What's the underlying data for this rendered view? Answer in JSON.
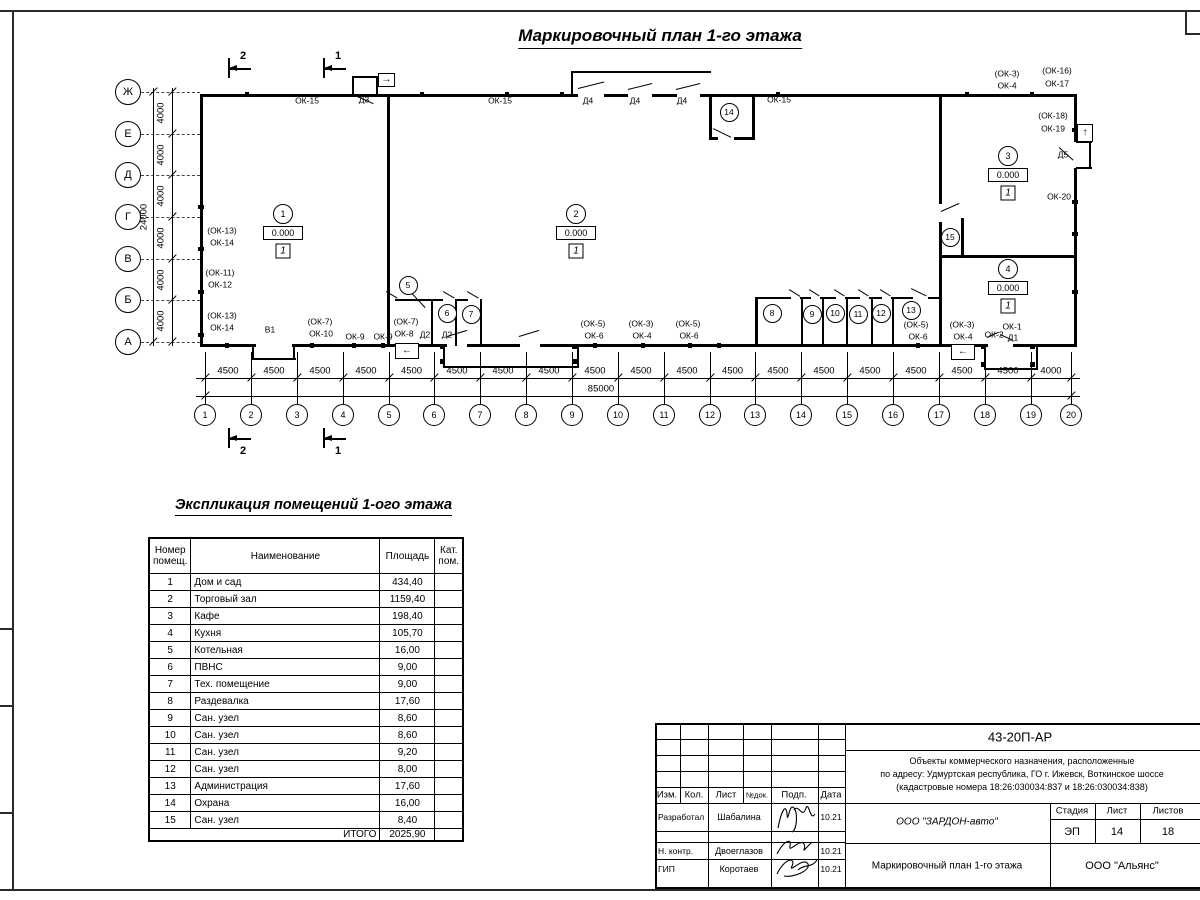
{
  "page": {
    "title": "Маркировочный план 1-го этажа"
  },
  "plan": {
    "axes": [
      {
        "label": "Ж",
        "y": 92
      },
      {
        "label": "Е",
        "y": 134
      },
      {
        "label": "Д",
        "y": 175
      },
      {
        "label": "Г",
        "y": 217
      },
      {
        "label": "В",
        "y": 259
      },
      {
        "label": "Б",
        "y": 300
      },
      {
        "label": "А",
        "y": 342
      }
    ],
    "axis_dims": [
      "4000",
      "4000",
      "4000",
      "4000",
      "4000",
      "4000"
    ],
    "axis_total": "24000",
    "columns": [
      {
        "label": "1",
        "x": 205
      },
      {
        "label": "2",
        "x": 251
      },
      {
        "label": "3",
        "x": 297
      },
      {
        "label": "4",
        "x": 343
      },
      {
        "label": "5",
        "x": 389
      },
      {
        "label": "6",
        "x": 434
      },
      {
        "label": "7",
        "x": 480
      },
      {
        "label": "8",
        "x": 526
      },
      {
        "label": "9",
        "x": 572
      },
      {
        "label": "10",
        "x": 618
      },
      {
        "label": "11",
        "x": 664
      },
      {
        "label": "12",
        "x": 710
      },
      {
        "label": "13",
        "x": 755
      },
      {
        "label": "14",
        "x": 801
      },
      {
        "label": "15",
        "x": 847
      },
      {
        "label": "16",
        "x": 893
      },
      {
        "label": "17",
        "x": 939
      },
      {
        "label": "18",
        "x": 985
      },
      {
        "label": "19",
        "x": 1031
      },
      {
        "label": "20",
        "x": 1071
      }
    ],
    "col_dims": [
      "4500",
      "4500",
      "4500",
      "4500",
      "4500",
      "4500",
      "4500",
      "4500",
      "4500",
      "4500",
      "4500",
      "4500",
      "4500",
      "4500",
      "4500",
      "4500",
      "4500",
      "4500",
      "4000"
    ],
    "col_total": "85000",
    "section_marks": [
      {
        "label": "2",
        "x": 228,
        "y": 68,
        "above": true
      },
      {
        "label": "1",
        "x": 323,
        "y": 68,
        "above": true
      },
      {
        "label": "2",
        "x": 228,
        "y": 438,
        "above": false
      },
      {
        "label": "1",
        "x": 323,
        "y": 438,
        "above": false
      }
    ],
    "room_markers": [
      {
        "num": "1",
        "elev": "0.000",
        "type": "1",
        "x": 283,
        "y": 214
      },
      {
        "num": "2",
        "elev": "0.000",
        "type": "1",
        "x": 576,
        "y": 214
      },
      {
        "num": "3",
        "elev": "0.000",
        "type": "1",
        "x": 1008,
        "y": 156
      },
      {
        "num": "4",
        "elev": "0.000",
        "type": "1",
        "x": 1008,
        "y": 269
      }
    ],
    "room_circles": [
      {
        "num": "5",
        "x": 408,
        "y": 285
      },
      {
        "num": "6",
        "x": 447,
        "y": 313
      },
      {
        "num": "7",
        "x": 471,
        "y": 314
      },
      {
        "num": "8",
        "x": 772,
        "y": 313
      },
      {
        "num": "9",
        "x": 812,
        "y": 314
      },
      {
        "num": "10",
        "x": 835,
        "y": 313
      },
      {
        "num": "11",
        "x": 858,
        "y": 314
      },
      {
        "num": "12",
        "x": 881,
        "y": 313
      },
      {
        "num": "13",
        "x": 911,
        "y": 310
      },
      {
        "num": "14",
        "x": 729,
        "y": 112
      },
      {
        "num": "15",
        "x": 950,
        "y": 237
      }
    ],
    "labels": [
      {
        "t": "ОК-15",
        "x": 307,
        "y": 101
      },
      {
        "t": "Д3",
        "x": 364,
        "y": 100
      },
      {
        "t": "ОК-15",
        "x": 500,
        "y": 101
      },
      {
        "t": "Д4",
        "x": 588,
        "y": 101
      },
      {
        "t": "Д4",
        "x": 635,
        "y": 101
      },
      {
        "t": "Д4",
        "x": 682,
        "y": 101
      },
      {
        "t": "ОК-15",
        "x": 779,
        "y": 100
      },
      {
        "t": "(ОК-3)",
        "x": 1007,
        "y": 74
      },
      {
        "t": "ОК-4",
        "x": 1007,
        "y": 86
      },
      {
        "t": "(ОК-16)",
        "x": 1057,
        "y": 71
      },
      {
        "t": "ОК-17",
        "x": 1057,
        "y": 84
      },
      {
        "t": "(ОК-18)",
        "x": 1053,
        "y": 116
      },
      {
        "t": "ОК-19",
        "x": 1053,
        "y": 129
      },
      {
        "t": "Д5",
        "x": 1063,
        "y": 155
      },
      {
        "t": "ОК-20",
        "x": 1059,
        "y": 197
      },
      {
        "t": "(ОК-13)",
        "x": 222,
        "y": 231
      },
      {
        "t": "ОК-14",
        "x": 222,
        "y": 243
      },
      {
        "t": "(ОК-11)",
        "x": 220,
        "y": 273
      },
      {
        "t": "ОК-12",
        "x": 220,
        "y": 285
      },
      {
        "t": "(ОК-13)",
        "x": 222,
        "y": 316
      },
      {
        "t": "ОК-14",
        "x": 222,
        "y": 328
      },
      {
        "t": "В1",
        "x": 270,
        "y": 330
      },
      {
        "t": "(ОК-7)",
        "x": 320,
        "y": 322
      },
      {
        "t": "ОК-10",
        "x": 321,
        "y": 334
      },
      {
        "t": "ОК-9",
        "x": 355,
        "y": 337
      },
      {
        "t": "ОК-9",
        "x": 383,
        "y": 337
      },
      {
        "t": "(ОК-7)",
        "x": 406,
        "y": 322
      },
      {
        "t": "ОК-8",
        "x": 404,
        "y": 334
      },
      {
        "t": "Д2",
        "x": 425,
        "y": 335
      },
      {
        "t": "Д2",
        "x": 447,
        "y": 335
      },
      {
        "t": "(ОК-5)",
        "x": 593,
        "y": 324
      },
      {
        "t": "ОК-6",
        "x": 594,
        "y": 336
      },
      {
        "t": "(ОК-3)",
        "x": 641,
        "y": 324
      },
      {
        "t": "ОК-4",
        "x": 642,
        "y": 336
      },
      {
        "t": "(ОК-5)",
        "x": 688,
        "y": 324
      },
      {
        "t": "ОК-6",
        "x": 689,
        "y": 336
      },
      {
        "t": "(ОК-5)",
        "x": 916,
        "y": 325
      },
      {
        "t": "ОК-6",
        "x": 918,
        "y": 337
      },
      {
        "t": "(ОК-3)",
        "x": 962,
        "y": 325
      },
      {
        "t": "ОК-4",
        "x": 963,
        "y": 337
      },
      {
        "t": "ОК-2",
        "x": 994,
        "y": 335
      },
      {
        "t": "ОК-1",
        "x": 1012,
        "y": 327
      },
      {
        "t": "Д1",
        "x": 1013,
        "y": 338
      }
    ],
    "entry_arrows": [
      "→",
      "↑",
      "←",
      "←"
    ]
  },
  "explication": {
    "title": "Экспликация помещений 1-ого этажа",
    "headers": [
      "Номер помещ.",
      "Наименование",
      "Площадь",
      "Кат. пом."
    ],
    "rows": [
      [
        "1",
        "Дом и сад",
        "434,40"
      ],
      [
        "2",
        "Торговый зал",
        "1159,40"
      ],
      [
        "3",
        "Кафе",
        "198,40"
      ],
      [
        "4",
        "Кухня",
        "105,70"
      ],
      [
        "5",
        "Котельная",
        "16,00"
      ],
      [
        "6",
        "ПВНС",
        "9,00"
      ],
      [
        "7",
        "Тех. помещение",
        "9,00"
      ],
      [
        "8",
        "Раздевалка",
        "17,60"
      ],
      [
        "9",
        "Сан. узел",
        "8,60"
      ],
      [
        "10",
        "Сан. узел",
        "8,60"
      ],
      [
        "11",
        "Сан. узел",
        "9,20"
      ],
      [
        "12",
        "Сан. узел",
        "8,00"
      ],
      [
        "13",
        "Администрация",
        "17,60"
      ],
      [
        "14",
        "Охрана",
        "16,00"
      ],
      [
        "15",
        "Сан. узел",
        "8,40"
      ]
    ],
    "total_label": "ИТОГО",
    "total_value": "2025,90"
  },
  "titleblock": {
    "doc_number": "43-20П-АР",
    "description_line1": "Объекты коммерческого назначения, расположенные",
    "description_line2": "по адресу: Удмуртская республика, ГО г. Ижевск, Воткинское шоссе",
    "description_line3": "(кадастровые номера 18:26:030034:837 и 18:26:030034:838)",
    "header_cells": [
      "Изм.",
      "Кол.",
      "Лист",
      "№док.",
      "Подп.",
      "Дата"
    ],
    "rows": [
      {
        "role": "Разработал",
        "name": "Шабалина",
        "date": "10.21"
      },
      {
        "role": "Н. контр.",
        "name": "Двоеглазов",
        "date": "10.21"
      },
      {
        "role": "ГИП",
        "name": "Коротаев",
        "date": "10.21"
      }
    ],
    "company": "ООО \"ЗАРДОН-авто\"",
    "stage_label": "Стадия",
    "sheet_label": "Лист",
    "sheets_label": "Листов",
    "stage": "ЭП",
    "sheet": "14",
    "sheets": "18",
    "drawing_name": "Маркировочный план 1-го этажа",
    "org": "ООО \"Альянс\""
  }
}
